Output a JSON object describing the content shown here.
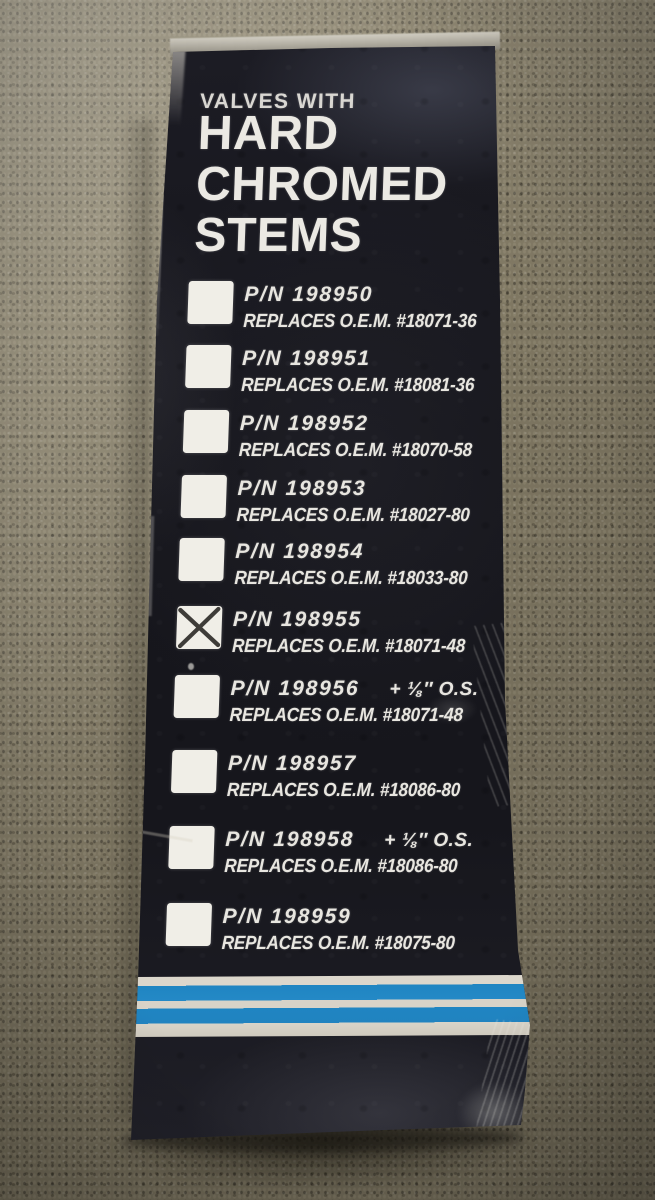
{
  "box_panel": {
    "kicker": "VALVES WITH",
    "title_line1": "HARD",
    "title_line2": "CHROMED",
    "title_line3": "STEMS",
    "items": [
      {
        "pn": "P/N 198950",
        "os": "",
        "replaces": "REPLACES O.E.M. #18071-36",
        "checked": false
      },
      {
        "pn": "P/N 198951",
        "os": "",
        "replaces": "REPLACES O.E.M. #18081-36",
        "checked": false
      },
      {
        "pn": "P/N 198952",
        "os": "",
        "replaces": "REPLACES O.E.M. #18070-58",
        "checked": false
      },
      {
        "pn": "P/N 198953",
        "os": "",
        "replaces": "REPLACES O.E.M. #18027-80",
        "checked": false
      },
      {
        "pn": "P/N 198954",
        "os": "",
        "replaces": "REPLACES O.E.M. #18033-80",
        "checked": false
      },
      {
        "pn": "P/N 198955",
        "os": "",
        "replaces": "REPLACES O.E.M. #18071-48",
        "checked": true
      },
      {
        "pn": "P/N 198956",
        "os": "+ ⅛″ O.S.",
        "replaces": "REPLACES O.E.M. #18071-48",
        "checked": false
      },
      {
        "pn": "P/N 198957",
        "os": "",
        "replaces": "REPLACES O.E.M. #18086-80",
        "checked": false
      },
      {
        "pn": "P/N 198958",
        "os": "+ ⅛″ O.S.",
        "replaces": "REPLACES O.E.M. #18086-80",
        "checked": false
      },
      {
        "pn": "P/N 198959",
        "os": "",
        "replaces": "REPLACES O.E.M. #18075-80",
        "checked": false
      }
    ],
    "check_icon": "x-mark",
    "colors": {
      "panel_black": "#16161c",
      "text_white": "#e8e6e0",
      "stripe_blue": "#1f85c2",
      "stripe_white": "#dcd7cc",
      "carpet": "#857d67"
    }
  }
}
